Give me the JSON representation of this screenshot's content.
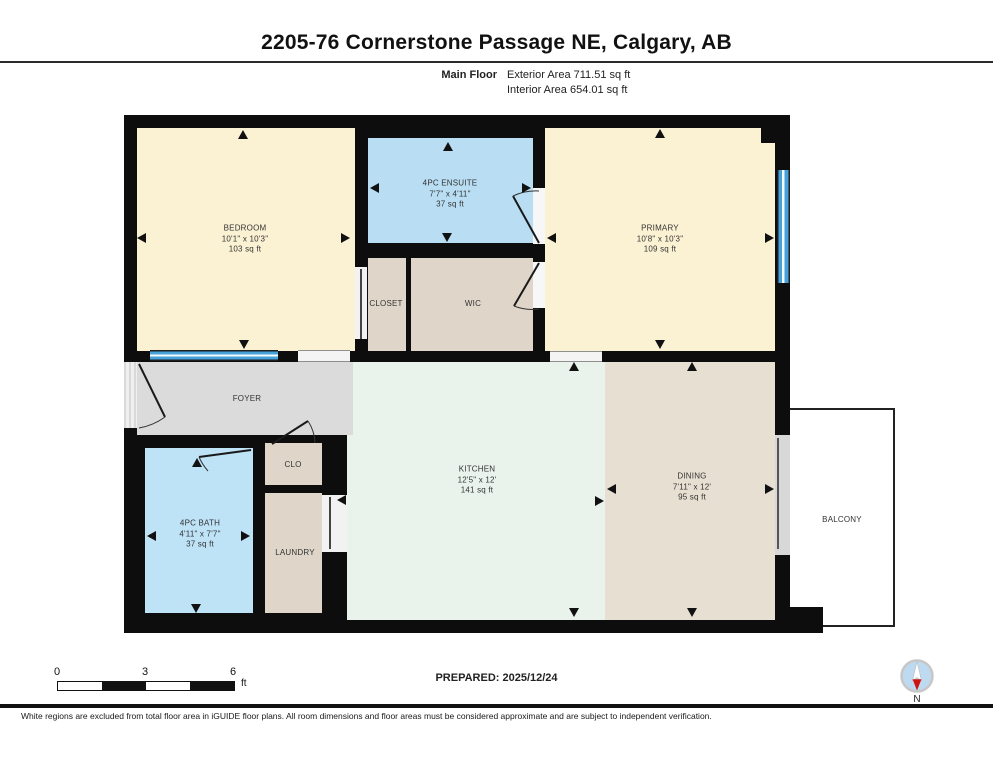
{
  "header": {
    "title": "2205-76 Cornerstone Passage NE, Calgary, AB",
    "floor_label": "Main Floor",
    "exterior_area": "Exterior Area 711.51 sq ft",
    "interior_area": "Interior Area 654.01 sq ft"
  },
  "footer": {
    "prepared_label": "PREPARED: 2025/12/24",
    "scale": {
      "t0": "0",
      "t1": "3",
      "t2": "6",
      "unit": "ft"
    },
    "compass_label": "N",
    "disclaimer": "White regions are excluded from total floor area in iGUIDE floor plans. All room dimensions and floor areas must be considered approximate and are subject to independent verification."
  },
  "colors": {
    "wall": "#0d0d0d",
    "cream": "#FBF1D3",
    "blue": "#B9DEF4",
    "bathblue": "#BEE2F6",
    "tan": "#DFD6C9",
    "dtan": "#E7DFD1",
    "mint": "#E9F2EB",
    "gray": "#DBDBDB",
    "window": "#47A1D9",
    "label": "#333333"
  },
  "plan": {
    "base": {
      "x": 124,
      "y": 115,
      "w": 666,
      "h": 518
    },
    "balcony": {
      "x": 788,
      "y": 408,
      "w": 107,
      "h": 219,
      "label": "BALCONY",
      "lx": 842,
      "ly": 520
    },
    "rooms": [
      {
        "id": "bedroom",
        "x": 137,
        "y": 128,
        "w": 218,
        "h": 223,
        "color": "cream",
        "lines": [
          "BEDROOM",
          "10'1\" x 10'3\"",
          "103 sq ft"
        ],
        "lx": 245,
        "ly": 239
      },
      {
        "id": "ensuite",
        "x": 368,
        "y": 138,
        "w": 165,
        "h": 105,
        "color": "blue",
        "lines": [
          "4PC ENSUITE",
          "7'7\" x 4'11\"",
          "37 sq ft"
        ],
        "lx": 450,
        "ly": 194
      },
      {
        "id": "primary",
        "x": 545,
        "y": 128,
        "w": 230,
        "h": 223,
        "color": "cream",
        "lines": [
          "PRIMARY",
          "10'8\" x 10'3\"",
          "109 sq ft"
        ],
        "lx": 660,
        "ly": 239
      },
      {
        "id": "closet",
        "x": 368,
        "y": 258,
        "w": 38,
        "h": 93,
        "color": "tan",
        "lines": [
          "CLOSET"
        ],
        "lx": 386,
        "ly": 304
      },
      {
        "id": "wic",
        "x": 411,
        "y": 258,
        "w": 122,
        "h": 93,
        "color": "tan",
        "lines": [
          "WIC"
        ],
        "lx": 473,
        "ly": 304
      },
      {
        "id": "kitchen",
        "x": 347,
        "y": 362,
        "w": 258,
        "h": 258,
        "color": "mint",
        "lines": [
          "KITCHEN",
          "12'5\" x 12'",
          "141 sq ft"
        ],
        "lx": 477,
        "ly": 480
      },
      {
        "id": "foyer",
        "x": 137,
        "y": 362,
        "w": 216,
        "h": 73,
        "color": "gray",
        "lines": [
          "FOYER"
        ],
        "lx": 247,
        "ly": 399
      },
      {
        "id": "dining",
        "x": 605,
        "y": 362,
        "w": 170,
        "h": 258,
        "color": "dtan",
        "lines": [
          "DINING",
          "7'11\" x 12'",
          "95 sq ft"
        ],
        "lx": 692,
        "ly": 487
      },
      {
        "id": "clo",
        "x": 265,
        "y": 443,
        "w": 57,
        "h": 42,
        "color": "tan",
        "lines": [
          "CLO"
        ],
        "lx": 293,
        "ly": 465
      },
      {
        "id": "laundry",
        "x": 265,
        "y": 493,
        "w": 57,
        "h": 120,
        "color": "tan",
        "lines": [
          "LAUNDRY"
        ],
        "lx": 295,
        "ly": 553
      },
      {
        "id": "bath",
        "x": 145,
        "y": 448,
        "w": 108,
        "h": 165,
        "color": "bathblue",
        "lines": [
          "4PC BATH",
          "4'11\" x 7'7\"",
          "37 sq ft"
        ],
        "lx": 200,
        "ly": 534
      }
    ],
    "notches": [
      {
        "id": "primary-top-right",
        "x": 761,
        "y": 128,
        "w": 14,
        "h": 15
      },
      {
        "id": "balcony-bottom-wall",
        "x": 788,
        "y": 607,
        "w": 35,
        "h": 26
      }
    ],
    "windows": [
      {
        "id": "bedroom-window",
        "x": 150,
        "y": 350,
        "w": 128,
        "h": 11,
        "orient": "h"
      },
      {
        "id": "primary-window",
        "x": 777,
        "y": 170,
        "w": 13,
        "h": 113,
        "orient": "v"
      }
    ],
    "gaps": [
      {
        "id": "bedroom-foyer-opening",
        "x": 298,
        "y": 350,
        "w": 52,
        "h": 12,
        "fill": "#f4f4f4",
        "edges": "h"
      },
      {
        "id": "primary-kitchen-opening",
        "x": 550,
        "y": 351,
        "w": 52,
        "h": 11,
        "fill": "#f4f4f4",
        "edges": "h"
      },
      {
        "id": "entry-opening",
        "x": 124,
        "y": 362,
        "w": 13,
        "h": 66,
        "fill": "#ececec",
        "edges": "hatch"
      },
      {
        "id": "ensuite-door-gap",
        "x": 533,
        "y": 188,
        "w": 12,
        "h": 56,
        "fill": "#f7f7f7",
        "edges": "none"
      },
      {
        "id": "wic-door-gap",
        "x": 533,
        "y": 262,
        "w": 12,
        "h": 46,
        "fill": "#f7f7f7",
        "edges": "none"
      },
      {
        "id": "closet-door-gap",
        "x": 355,
        "y": 267,
        "w": 12,
        "h": 72,
        "fill": "#f2f2f2",
        "edges": "none"
      },
      {
        "id": "laundry-door-gap",
        "x": 322,
        "y": 495,
        "w": 25,
        "h": 57,
        "fill": "#f2f2f2",
        "edges": "none"
      },
      {
        "id": "balcony-door-gap",
        "x": 775,
        "y": 435,
        "w": 15,
        "h": 120,
        "fill": "#d8d8d8",
        "edges": "none"
      }
    ],
    "doors": [
      {
        "id": "entry-door-leaf",
        "d": "M139,364 L165,417",
        "w": 2,
        "stroke": "#1a1a1a"
      },
      {
        "id": "entry-door-arc",
        "d": "M139,428 A62,62 0 0 0 165,417",
        "w": 1,
        "stroke": "#333"
      },
      {
        "id": "bath-door-leaf",
        "d": "M251,450 L199,457",
        "w": 2,
        "stroke": "#1a1a1a"
      },
      {
        "id": "bath-door-arc",
        "d": "M199,457 A53,53 0 0 0 208,471",
        "w": 1,
        "stroke": "#333"
      },
      {
        "id": "clo-door-leaf",
        "d": "M272,444 L308,421",
        "w": 2,
        "stroke": "#1a1a1a"
      },
      {
        "id": "clo-door-arc",
        "d": "M308,421 A43,43 0 0 1 315,443",
        "w": 1,
        "stroke": "#333"
      },
      {
        "id": "ensuite-door-leaf",
        "d": "M539,243 L513,196",
        "w": 2,
        "stroke": "#1a1a1a"
      },
      {
        "id": "ensuite-door-arc",
        "d": "M539,191 A53,53 0 0 0 513,196",
        "w": 1,
        "stroke": "#333"
      },
      {
        "id": "wic-door-leaf",
        "d": "M539,263 L514,306",
        "w": 2,
        "stroke": "#1a1a1a"
      },
      {
        "id": "wic-door-arc",
        "d": "M539,309 A50,50 0 0 1 514,306",
        "w": 1,
        "stroke": "#333"
      },
      {
        "id": "closet-slider",
        "d": "M361,269 L361,339",
        "w": 2,
        "stroke": "#444"
      },
      {
        "id": "laundry-slider",
        "d": "M330,497 L330,549",
        "w": 2,
        "stroke": "#444"
      },
      {
        "id": "balcony-slider",
        "d": "M778,438 L778,549",
        "w": 2,
        "stroke": "#555"
      }
    ],
    "arrows": [
      {
        "x": 243,
        "y": 134,
        "dir": "up"
      },
      {
        "x": 141,
        "y": 238,
        "dir": "left"
      },
      {
        "x": 345,
        "y": 238,
        "dir": "right"
      },
      {
        "x": 244,
        "y": 344,
        "dir": "down"
      },
      {
        "x": 448,
        "y": 146,
        "dir": "up"
      },
      {
        "x": 374,
        "y": 188,
        "dir": "left"
      },
      {
        "x": 526,
        "y": 188,
        "dir": "right"
      },
      {
        "x": 447,
        "y": 237,
        "dir": "down"
      },
      {
        "x": 660,
        "y": 133,
        "dir": "up"
      },
      {
        "x": 551,
        "y": 238,
        "dir": "left"
      },
      {
        "x": 769,
        "y": 238,
        "dir": "right"
      },
      {
        "x": 660,
        "y": 344,
        "dir": "down"
      },
      {
        "x": 574,
        "y": 366,
        "dir": "up"
      },
      {
        "x": 574,
        "y": 612,
        "dir": "down"
      },
      {
        "x": 599,
        "y": 501,
        "dir": "right"
      },
      {
        "x": 692,
        "y": 366,
        "dir": "up"
      },
      {
        "x": 692,
        "y": 612,
        "dir": "down"
      },
      {
        "x": 611,
        "y": 489,
        "dir": "left"
      },
      {
        "x": 769,
        "y": 489,
        "dir": "right"
      },
      {
        "x": 197,
        "y": 462,
        "dir": "up"
      },
      {
        "x": 151,
        "y": 536,
        "dir": "left"
      },
      {
        "x": 245,
        "y": 536,
        "dir": "right"
      },
      {
        "x": 196,
        "y": 608,
        "dir": "down"
      },
      {
        "x": 341,
        "y": 500,
        "dir": "left"
      }
    ]
  }
}
